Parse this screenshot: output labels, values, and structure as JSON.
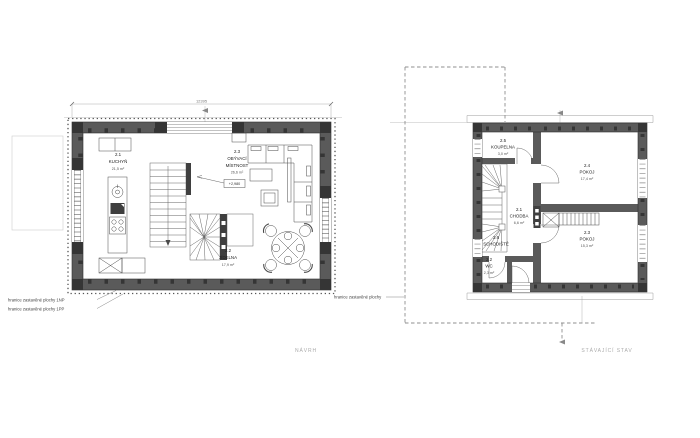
{
  "captions": {
    "left": "NÁVRH",
    "right": "STÁVAJÍCÍ STAV"
  },
  "boundary_labels": {
    "np1": "hranice zastavěné plochy 1NP",
    "pp1": "hranice zastavěné plochy 1PP",
    "plain": "hranice zastavěné plochy"
  },
  "left_plan": {
    "dimension_top": "12395",
    "level_marker": "+2,980",
    "rooms": [
      {
        "num": "2.1",
        "name": "KUCHYŇ",
        "area": "21,5 m²"
      },
      {
        "num": "2.3",
        "name": "OBÝVACÍ",
        "name2": "MÍSTNOST",
        "area": "26,6 m²"
      },
      {
        "num": "2.2",
        "name": "JÍDELNA",
        "area": "17,9 m²"
      }
    ]
  },
  "right_plan": {
    "rooms": [
      {
        "num": "2.5",
        "name": "KOUPELNA",
        "area": "3,0 m²"
      },
      {
        "num": "2.4",
        "name": "POKOJ",
        "area": "17,4 m²"
      },
      {
        "num": "2.1",
        "name": "CHODBA",
        "area": "6,6 m²"
      },
      {
        "num": "2.6",
        "name": "SCHODIŠTĚ",
        "area": ""
      },
      {
        "num": "2.2",
        "name": "WC",
        "area": "2,3 m²"
      },
      {
        "num": "2.3",
        "name": "POKOJ",
        "area": "15,3 m²"
      }
    ]
  },
  "colors": {
    "wall": "#5a5a5a",
    "stud": "#353535",
    "line": "#4a4a4a",
    "dashed_boundary": "#8f8f8f",
    "caption_gray": "#ababab"
  }
}
